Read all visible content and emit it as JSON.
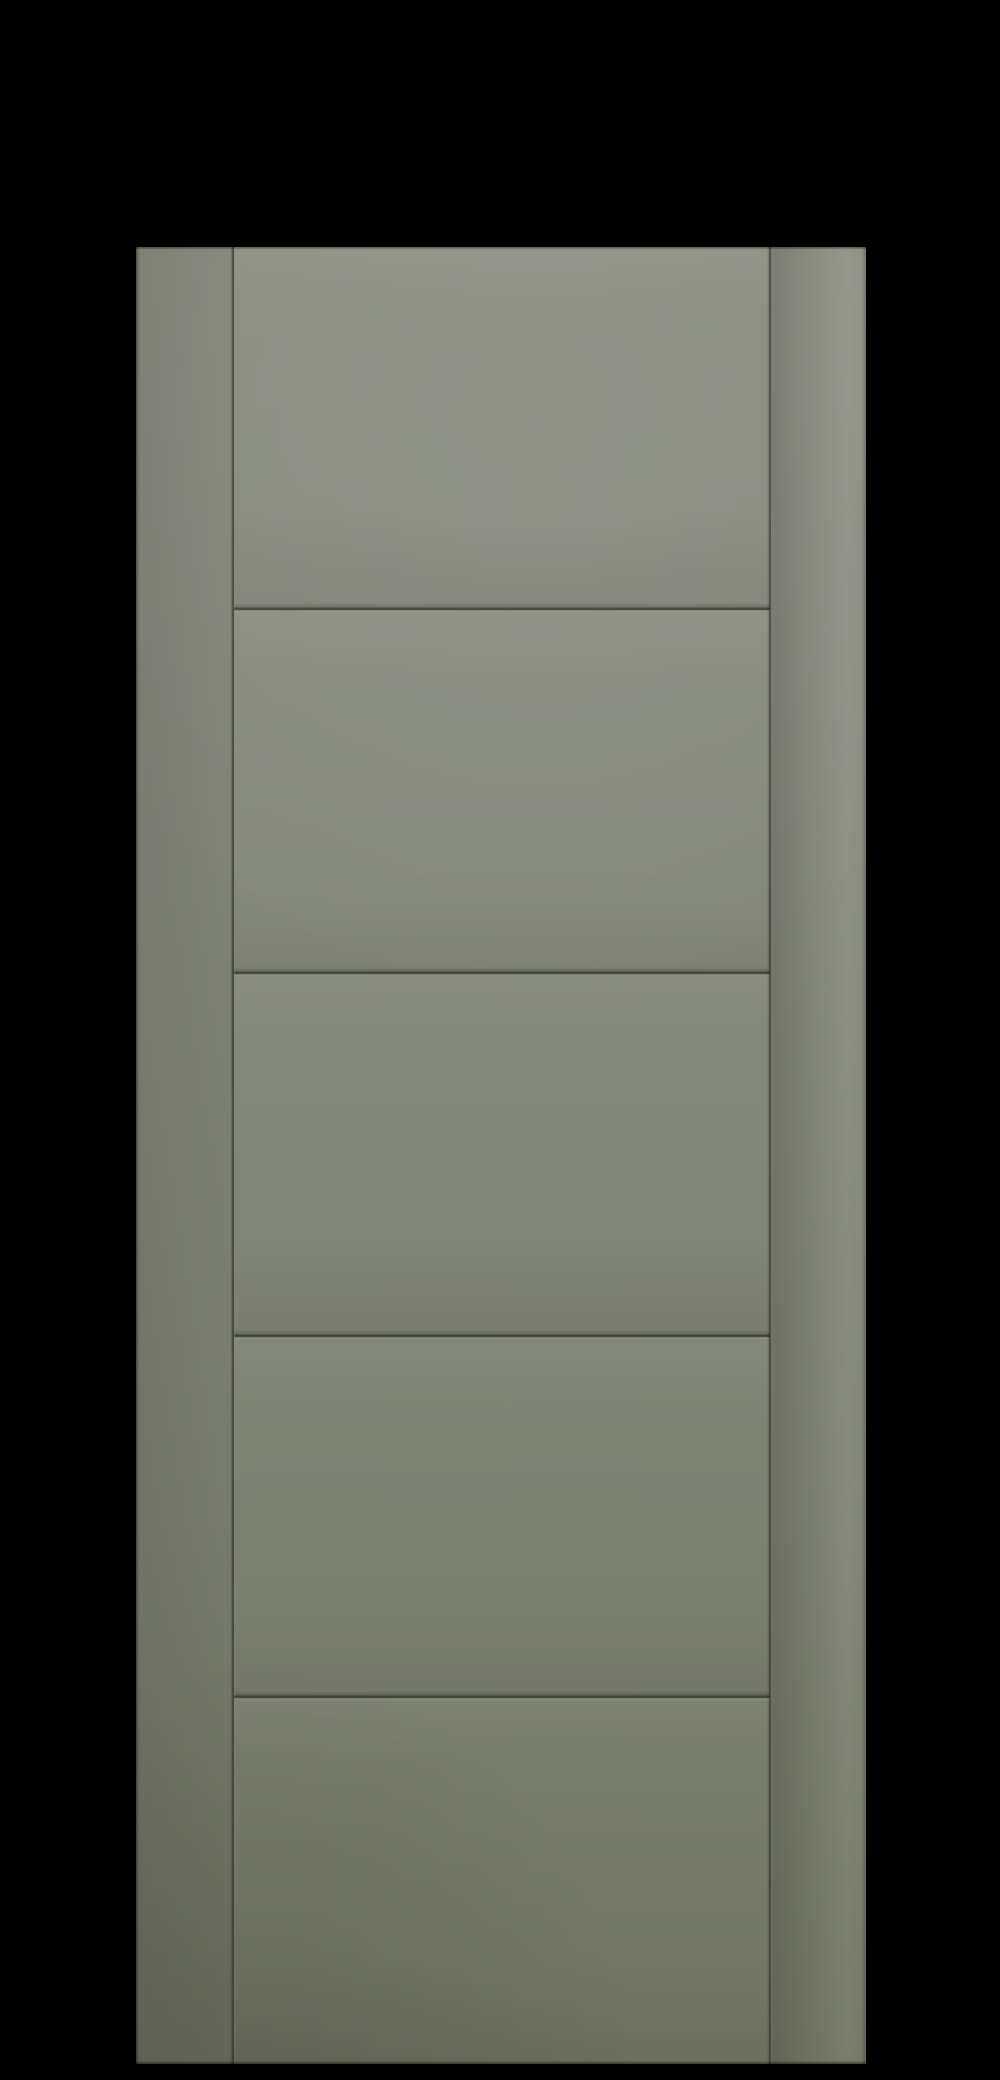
{
  "scene": {
    "description": "Product render of a sage-green five-panel ladder-style interior door slab centred on a black background. No text, labels or controls are visible.",
    "panel_count": 5
  },
  "door": {
    "label": "Sage green five-panel interior door",
    "stiles": [
      "left-stile",
      "right-stile"
    ],
    "panels": [
      "panel-1",
      "panel-2",
      "panel-3",
      "panel-4",
      "panel-5"
    ]
  },
  "colors": {
    "background": "#000000",
    "door_top": "#8b8e7f",
    "door_upper": "#868a7b",
    "door_lower": "#7e8271",
    "door_bottom": "#717562",
    "left_stile_tint": "#7b7f6f",
    "right_stile_edge": "#8d9181",
    "groove": "#3a3e31"
  }
}
